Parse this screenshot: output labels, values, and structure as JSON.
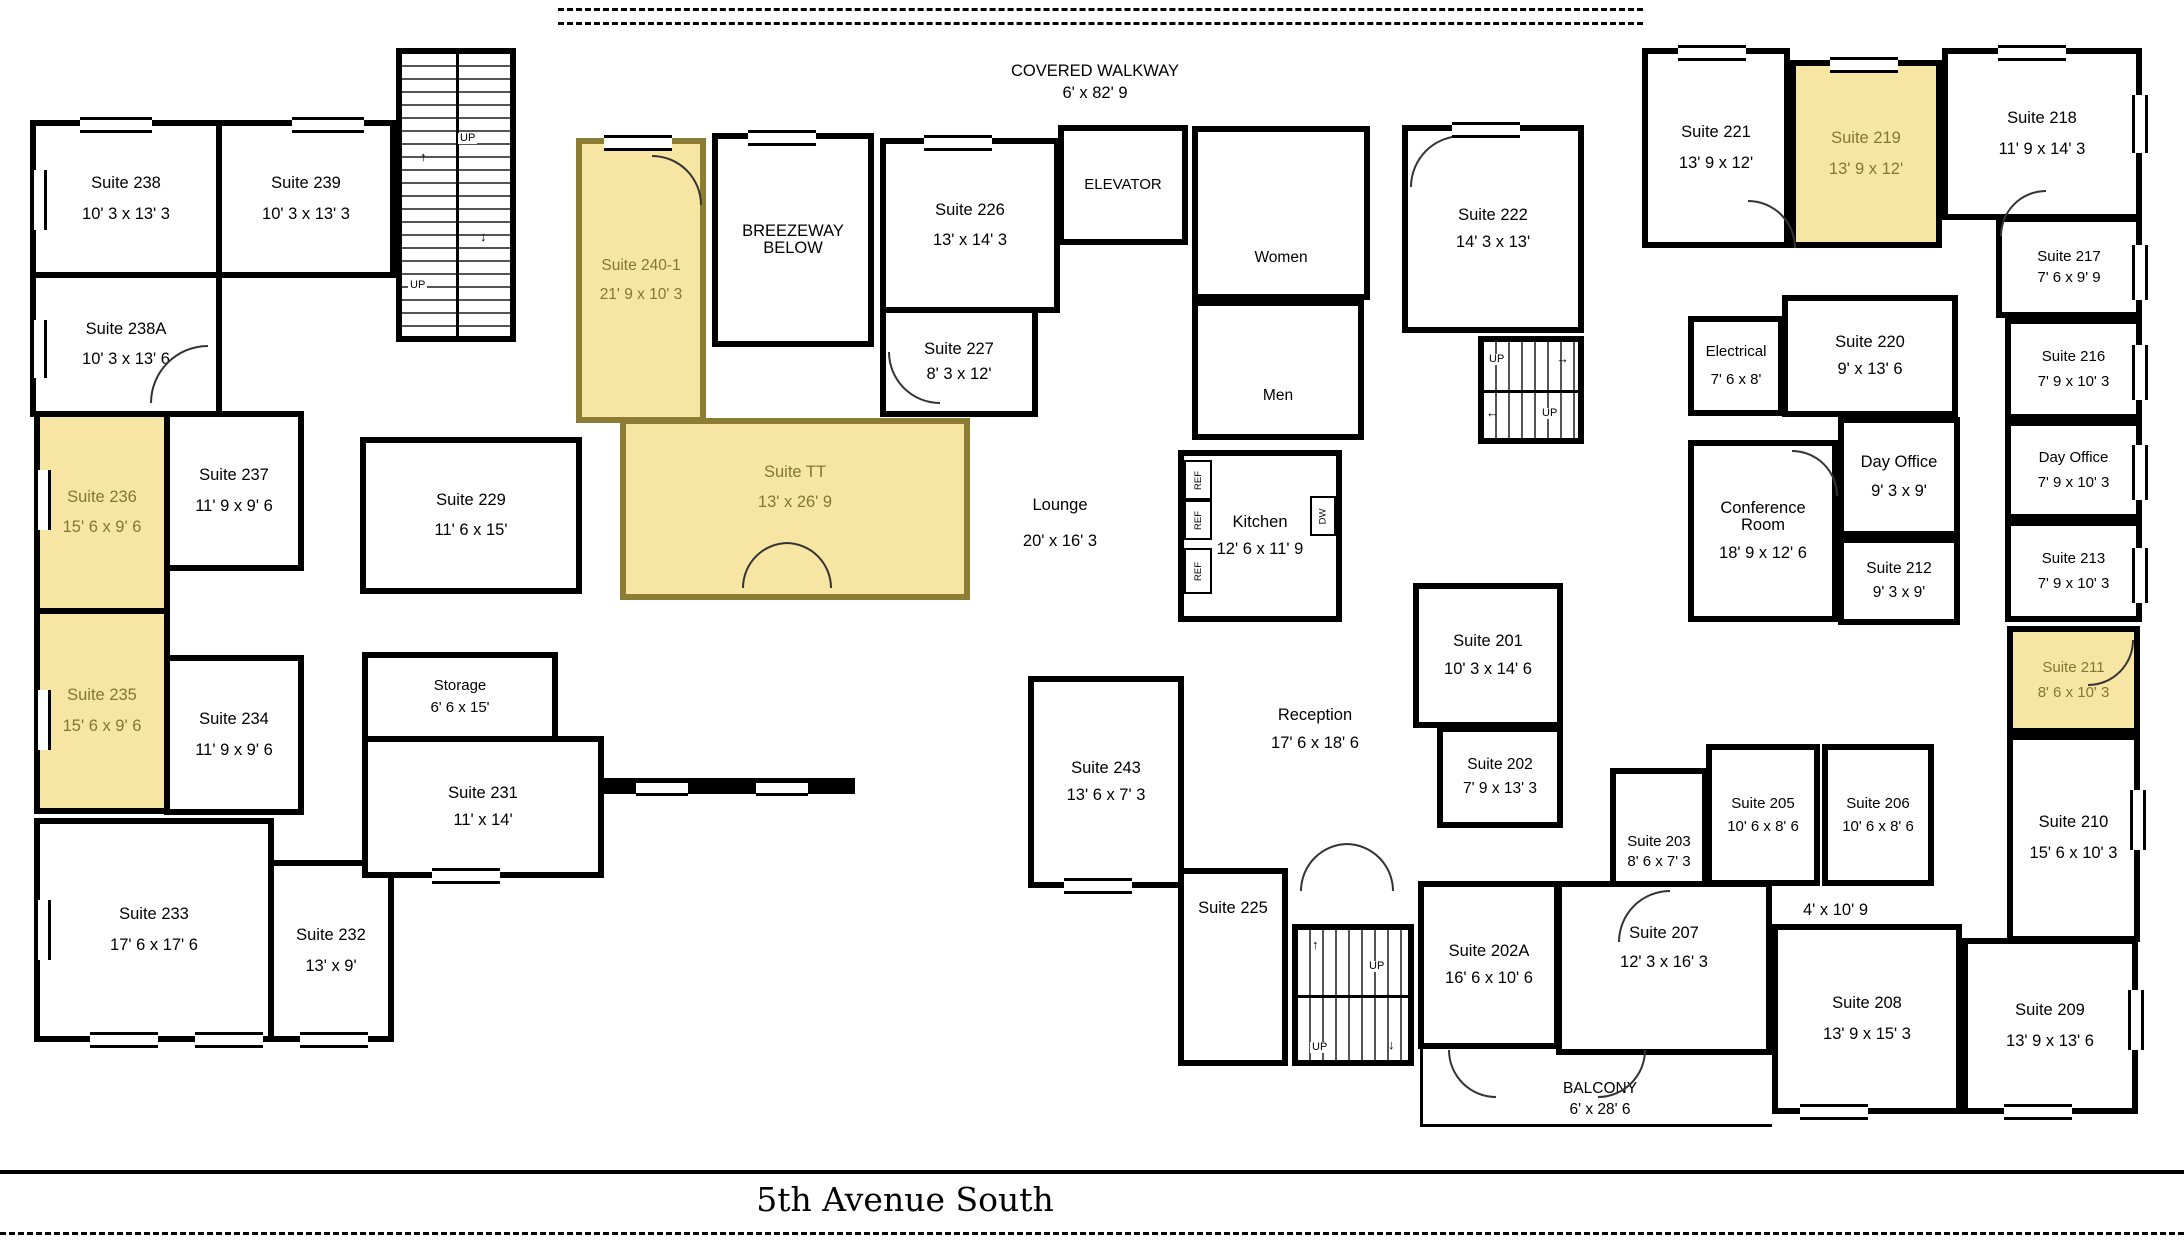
{
  "colors": {
    "highlight_fill": "#F7E6A3",
    "highlight_text": "#857434",
    "highlight_border": "#8d7c33",
    "wall": "#000000",
    "text": "#000000"
  },
  "street_label": "5th Avenue South",
  "areas": {
    "covered_walkway": {
      "label": "COVERED WALKWAY",
      "dims": "6' x 82' 9"
    },
    "balcony": {
      "label": "BALCONY",
      "dims": "6' x 28' 6"
    },
    "breezeway": {
      "label": "BREEZEWAY BELOW"
    }
  },
  "misc": {
    "elevator": "ELEVATOR",
    "women": "Women",
    "men": "Men",
    "up": "UP",
    "ref": "REF",
    "dw": "DW",
    "corridor_dims": "4' x 10' 9",
    "up_arrow": "↑",
    "down_arrow": "↓",
    "right_arrow": "→",
    "left_arrow": "←"
  },
  "rooms": {
    "s238": {
      "label": "Suite 238",
      "dims": "10' 3 x 13' 3",
      "highlight": false
    },
    "s239": {
      "label": "Suite 239",
      "dims": "10' 3 x 13' 3",
      "highlight": false
    },
    "s238a": {
      "label": "Suite 238A",
      "dims": "10' 3 x 13' 6",
      "highlight": false
    },
    "s236": {
      "label": "Suite 236",
      "dims": "15' 6 x 9' 6",
      "highlight": true
    },
    "s237": {
      "label": "Suite 237",
      "dims": "11' 9 x 9' 6",
      "highlight": false
    },
    "s235": {
      "label": "Suite 235",
      "dims": "15' 6 x 9' 6",
      "highlight": true
    },
    "s234": {
      "label": "Suite 234",
      "dims": "11' 9 x 9' 6",
      "highlight": false
    },
    "s233": {
      "label": "Suite 233",
      "dims": "17' 6 x 17' 6",
      "highlight": false
    },
    "s232": {
      "label": "Suite 232",
      "dims": "13' x 9'",
      "highlight": false
    },
    "s229": {
      "label": "Suite 229",
      "dims": "11' 6 x 15'",
      "highlight": false
    },
    "storage": {
      "label": "Storage",
      "dims": "6' 6 x 15'",
      "highlight": false
    },
    "s231": {
      "label": "Suite 231",
      "dims": "11' x 14'",
      "highlight": false
    },
    "s240_1": {
      "label": "Suite 240-1",
      "dims": "21' 9 x 10' 3",
      "highlight": true
    },
    "stt": {
      "label": "Suite TT",
      "dims": "13' x 26' 9",
      "highlight": true
    },
    "s226": {
      "label": "Suite 226",
      "dims": "13' x 14' 3",
      "highlight": false
    },
    "s227": {
      "label": "Suite 227",
      "dims": "8' 3 x 12'",
      "highlight": false
    },
    "s222": {
      "label": "Suite 222",
      "dims": "14' 3 x 13'",
      "highlight": false
    },
    "s221": {
      "label": "Suite 221",
      "dims": "13' 9 x 12'",
      "highlight": false
    },
    "s219": {
      "label": "Suite 219",
      "dims": "13' 9 x 12'",
      "highlight": true
    },
    "s218": {
      "label": "Suite 218",
      "dims": "11' 9 x 14' 3",
      "highlight": false
    },
    "s217": {
      "label": "Suite 217",
      "dims": "7' 6 x 9' 9",
      "highlight": false
    },
    "s216": {
      "label": "Suite 216",
      "dims": "7' 9 x 10' 3",
      "highlight": false
    },
    "electrical": {
      "label": "Electrical",
      "dims": "7' 6 x 8'",
      "highlight": false
    },
    "s220": {
      "label": "Suite 220",
      "dims": "9' x 13' 6",
      "highlight": false
    },
    "day_office_a": {
      "label": "Day Office",
      "dims": "9' 3 x 9'",
      "highlight": false
    },
    "day_office_b": {
      "label": "Day Office",
      "dims": "7' 9 x 10' 3",
      "highlight": false
    },
    "conference": {
      "label": "Conference Room",
      "dims": "18' 9 x 12' 6",
      "highlight": false
    },
    "s212": {
      "label": "Suite 212",
      "dims": "9' 3 x 9'",
      "highlight": false
    },
    "s213": {
      "label": "Suite 213",
      "dims": "7' 9 x 10' 3",
      "highlight": false
    },
    "s211": {
      "label": "Suite 211",
      "dims": "8' 6 x 10' 3",
      "highlight": true
    },
    "s210": {
      "label": "Suite 210",
      "dims": "15' 6 x 10' 3",
      "highlight": false
    },
    "s209": {
      "label": "Suite 209",
      "dims": "13' 9 x 13' 6",
      "highlight": false
    },
    "s208": {
      "label": "Suite 208",
      "dims": "13' 9 x 15' 3",
      "highlight": false
    },
    "s207": {
      "label": "Suite 207",
      "dims": "12' 3 x 16' 3",
      "highlight": false
    },
    "s202a": {
      "label": "Suite 202A",
      "dims": "16' 6 x 10' 6",
      "highlight": false
    },
    "s201": {
      "label": "Suite 201",
      "dims": "10' 3 x 14' 6",
      "highlight": false
    },
    "s202": {
      "label": "Suite 202",
      "dims": "7' 9 x 13' 3",
      "highlight": false
    },
    "s203": {
      "label": "Suite 203",
      "dims": "8' 6 x 7' 3",
      "highlight": false
    },
    "s205": {
      "label": "Suite 205",
      "dims": "10' 6 x 8' 6",
      "highlight": false
    },
    "s206": {
      "label": "Suite 206",
      "dims": "10' 6 x 8' 6",
      "highlight": false
    },
    "s243": {
      "label": "Suite 243",
      "dims": "13' 6 x 7' 3",
      "highlight": false
    },
    "s225": {
      "label": "Suite 225",
      "dims": "13' 6 x 7' 3",
      "highlight": false
    },
    "lounge": {
      "label": "Lounge",
      "dims": "20' x 16' 3",
      "highlight": false
    },
    "kitchen": {
      "label": "Kitchen",
      "dims": "12' 6 x 11' 9",
      "highlight": false
    },
    "reception": {
      "label": "Reception",
      "dims": "17' 6 x 18' 6",
      "highlight": false
    }
  }
}
